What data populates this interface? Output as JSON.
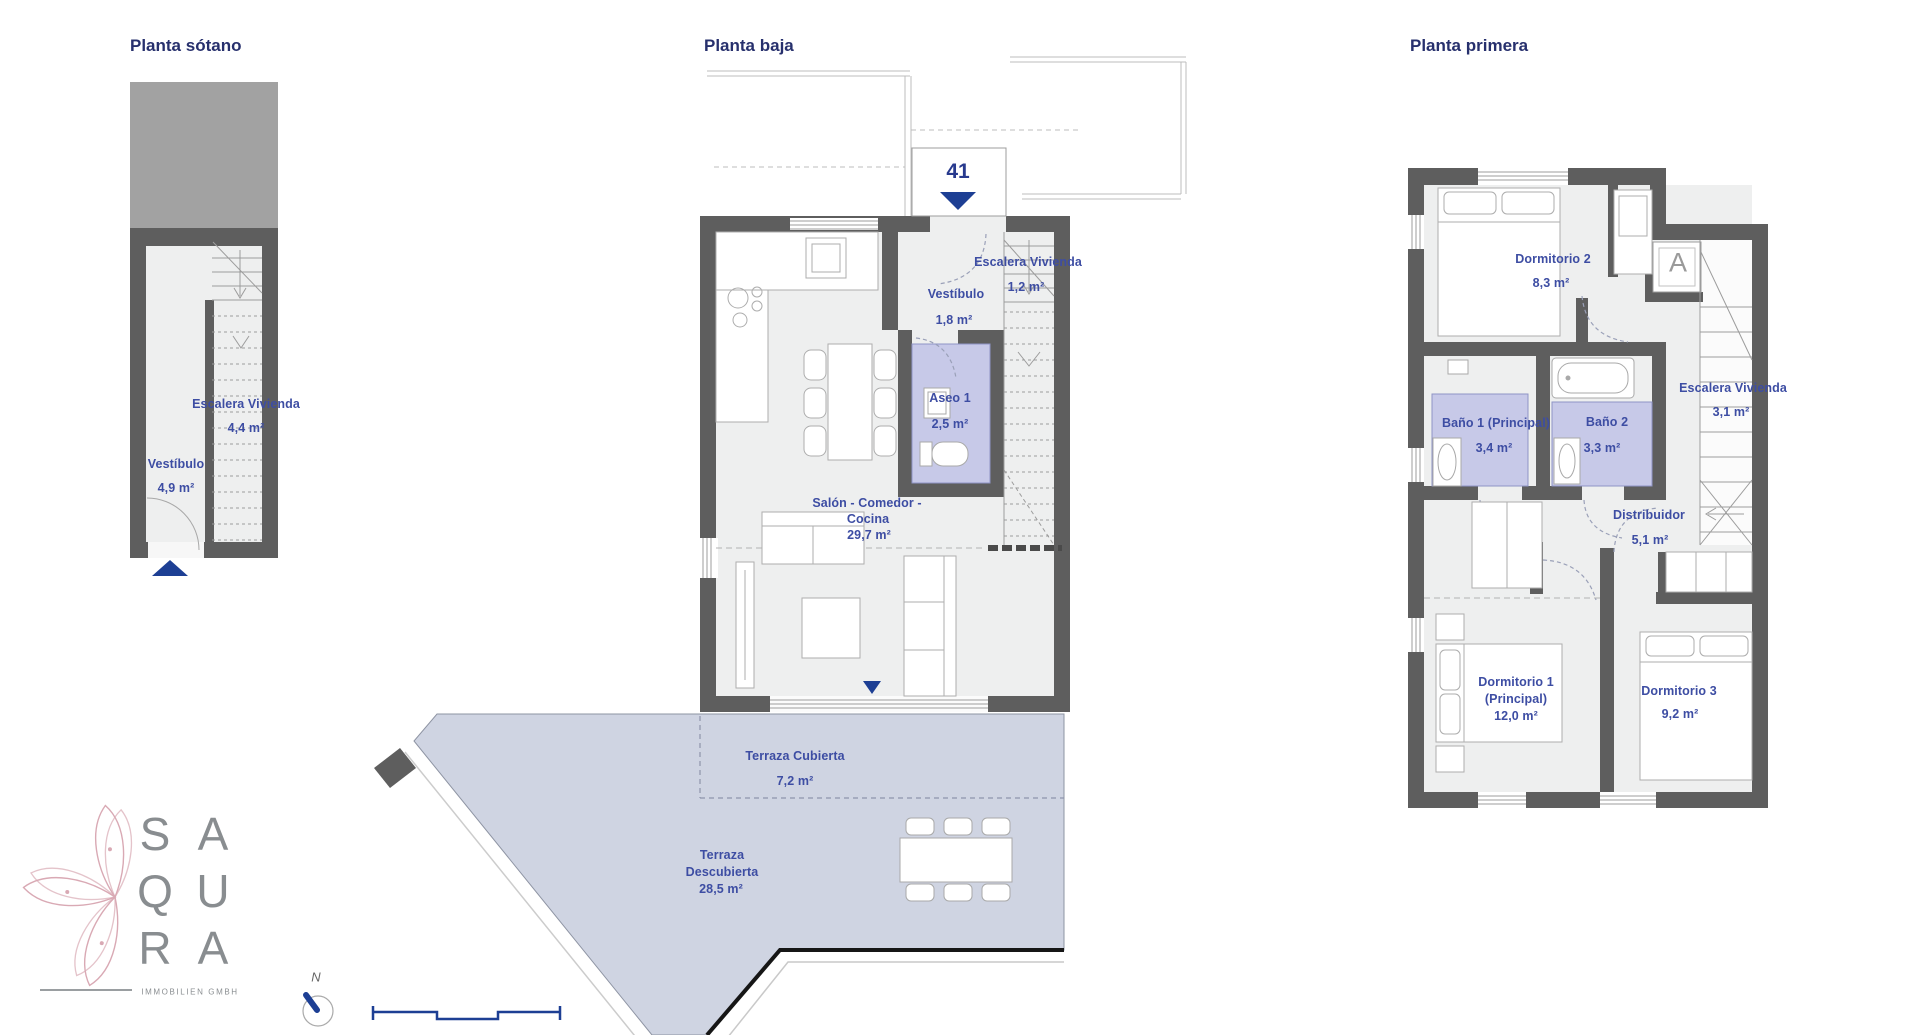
{
  "document": {
    "type": "floor-plan-sheet"
  },
  "colors": {
    "title_navy": "#27306d",
    "label_blue": "#3d4da3",
    "accent_navy": "#1d3f94",
    "wall_gray": "#5e5e5e",
    "floor_gray": "#eeefef",
    "bath_lavender": "#c7c9e8",
    "terrace_blue": "#cfd4e2",
    "block_gray": "#a2a2a2",
    "logo_pink": "#d9a9b4",
    "logo_gray": "#898d90"
  },
  "plans": {
    "basement": {
      "title": "Planta sótano",
      "rooms": [
        {
          "name": "Escalera Vivienda",
          "area": "4,4 m²"
        },
        {
          "name": "Vestíbulo",
          "area": "4,9 m²"
        }
      ]
    },
    "ground": {
      "title": "Planta baja",
      "unit_number": "41",
      "rooms": [
        {
          "name": "Escalera Vivienda",
          "area": "1,2 m²"
        },
        {
          "name": "Vestíbulo",
          "area": "1,8 m²"
        },
        {
          "name": "Aseo 1",
          "area": "2,5 m²"
        },
        {
          "name": "Salón - Comedor -",
          "name2": "Cocina",
          "area": "29,7 m²"
        },
        {
          "name": "Terraza Cubierta",
          "area": "7,2 m²"
        },
        {
          "name": "Terraza",
          "name2": "Descubierta",
          "area": "28,5 m²"
        }
      ]
    },
    "first": {
      "title": "Planta primera",
      "ac_label": "A",
      "rooms": [
        {
          "name": "Dormitorio 2",
          "area": "8,3 m²"
        },
        {
          "name": "Escalera Vivienda",
          "area": "3,1 m²"
        },
        {
          "name": "Baño 1 (Principal)",
          "area": "3,4 m²"
        },
        {
          "name": "Baño 2",
          "area": "3,3 m²"
        },
        {
          "name": "Distribuidor",
          "area": "5,1 m²"
        },
        {
          "name": "Dormitorio 1",
          "name2": "(Principal)",
          "area": "12,0 m²"
        },
        {
          "name": "Dormitorio 3",
          "area": "9,2 m²"
        }
      ]
    }
  },
  "logo": {
    "rows": [
      [
        "S",
        "A"
      ],
      [
        "Q",
        "U"
      ],
      [
        "R",
        "A"
      ]
    ],
    "subtitle": "IMMOBILIEN GMBH"
  },
  "compass": {
    "label": "N"
  }
}
